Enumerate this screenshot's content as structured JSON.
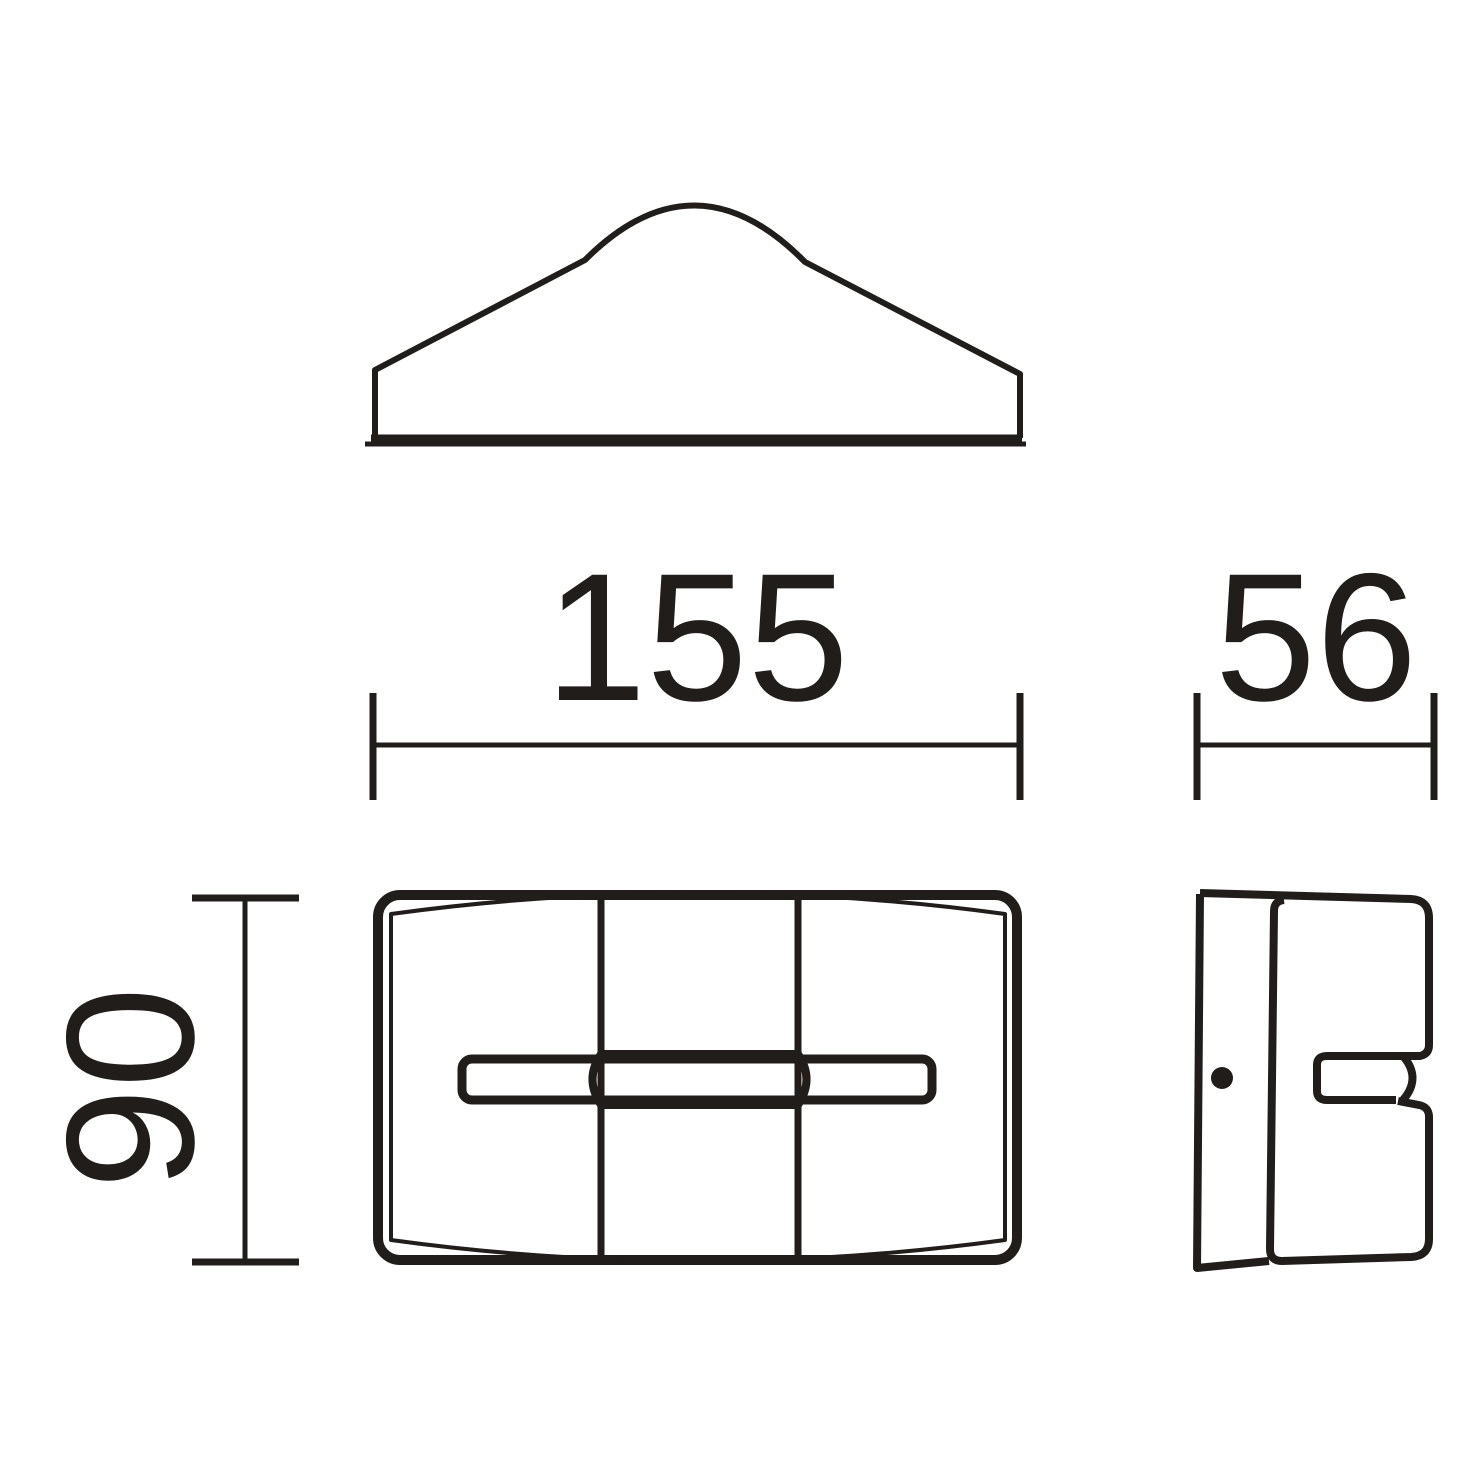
{
  "drawing": {
    "dimensions": {
      "width": "155",
      "depth": "56",
      "height": "90"
    },
    "colors": {
      "line": "#211d1a",
      "background": "#ffffff"
    }
  }
}
